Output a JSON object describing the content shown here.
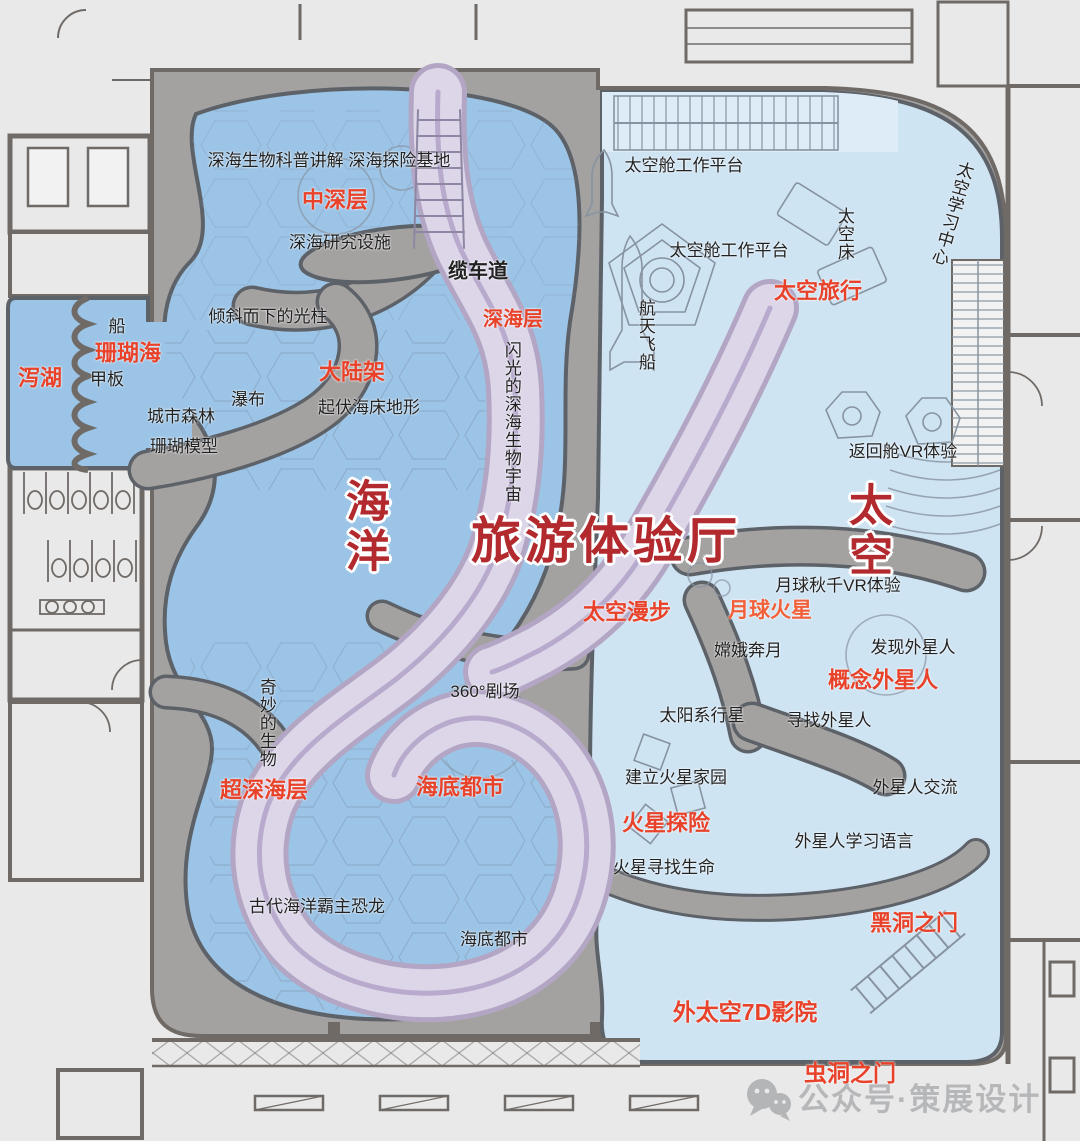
{
  "colors": {
    "background": "#e9e9ea",
    "room_fill": "#f2f2f3",
    "hall_gray": "#a4a2a1",
    "wall_dark": "#6f6a66",
    "zone_outline": "#5d6168",
    "ocean_blue": "#9cc4e6",
    "space_blue": "#cfe4f3",
    "space_blue_light": "#ddecf7",
    "path_purple": "#ddd6e9",
    "path_edge": "#b2a6c4",
    "path_stripe": "#b7aacd",
    "detail_line": "#8793a1",
    "texture_line": "#7e95ad",
    "label_black": "#222222",
    "label_red": "#e8432a",
    "label_orange": "#f2603a",
    "title_red": "#b2292e",
    "watermark_gray": "#b4b5b7"
  },
  "titles": {
    "hall": {
      "text": "旅游体验厅"
    },
    "ocean": {
      "text": "海洋"
    },
    "space": {
      "text": "太空"
    }
  },
  "labels": {
    "deep_sea_science": {
      "text": "深海生物科普讲解 深海探险基地"
    },
    "mid_deep_layer": {
      "text": "中深层"
    },
    "deep_sea_research": {
      "text": "深海研究设施"
    },
    "cable_road": {
      "text": "缆车道"
    },
    "light_beam": {
      "text": "倾斜而下的光柱"
    },
    "deep_sea_layer": {
      "text": "深海层"
    },
    "boat": {
      "text": "船"
    },
    "coral_sea": {
      "text": "珊瑚海"
    },
    "lagoon": {
      "text": "泻湖"
    },
    "deck": {
      "text": "甲板"
    },
    "continental_shelf": {
      "text": "大陆架"
    },
    "waterfall": {
      "text": "瀑布"
    },
    "seabed_terrain": {
      "text": "起伏海床地形"
    },
    "city_forest": {
      "text": "城市森林"
    },
    "coral_model": {
      "text": "珊瑚模型"
    },
    "glowing_universe": {
      "text": "闪光的深海生物宇宙"
    },
    "wonderful_creatures": {
      "text": "奇妙的生物"
    },
    "theater_360": {
      "text": "360°剧场"
    },
    "ultra_deep_layer": {
      "text": "超深海层"
    },
    "seabed_city_red": {
      "text": "海底都市"
    },
    "ancient_dinosaur": {
      "text": "古代海洋霸主恐龙"
    },
    "seabed_city_black": {
      "text": "海底都市"
    },
    "capsule_platform_1": {
      "text": "太空舱工作平台"
    },
    "capsule_platform_2": {
      "text": "太空舱工作平台"
    },
    "space_bed": {
      "text": "太空床"
    },
    "space_learning_center": {
      "text": "太空学习中心"
    },
    "space_travel": {
      "text": "太空旅行"
    },
    "spaceship": {
      "text": "航天飞船"
    },
    "return_capsule_vr": {
      "text": "返回舱VR体验"
    },
    "moon_swing_vr": {
      "text": "月球秋千VR体验"
    },
    "moon_mars": {
      "text": "月球火星"
    },
    "space_walk": {
      "text": "太空漫步"
    },
    "change_flying": {
      "text": "嫦娥奔月"
    },
    "discover_aliens": {
      "text": "发现外星人"
    },
    "concept_aliens": {
      "text": "概念外星人"
    },
    "solar_planets": {
      "text": "太阳系行星"
    },
    "find_aliens": {
      "text": "寻找外星人"
    },
    "mars_home": {
      "text": "建立火星家园"
    },
    "alien_communication": {
      "text": "外星人交流"
    },
    "mars_adventure": {
      "text": "火星探险"
    },
    "alien_language": {
      "text": "外星人学习语言"
    },
    "mars_life": {
      "text": "火星寻找生命"
    },
    "black_hole_gate": {
      "text": "黑洞之门"
    },
    "outer_space_7d": {
      "text": "外太空7D影院"
    },
    "wormhole_gate": {
      "text": "虫洞之门"
    }
  },
  "watermark": {
    "text": "公众号·策展设计",
    "icon": "wechat-icon"
  }
}
